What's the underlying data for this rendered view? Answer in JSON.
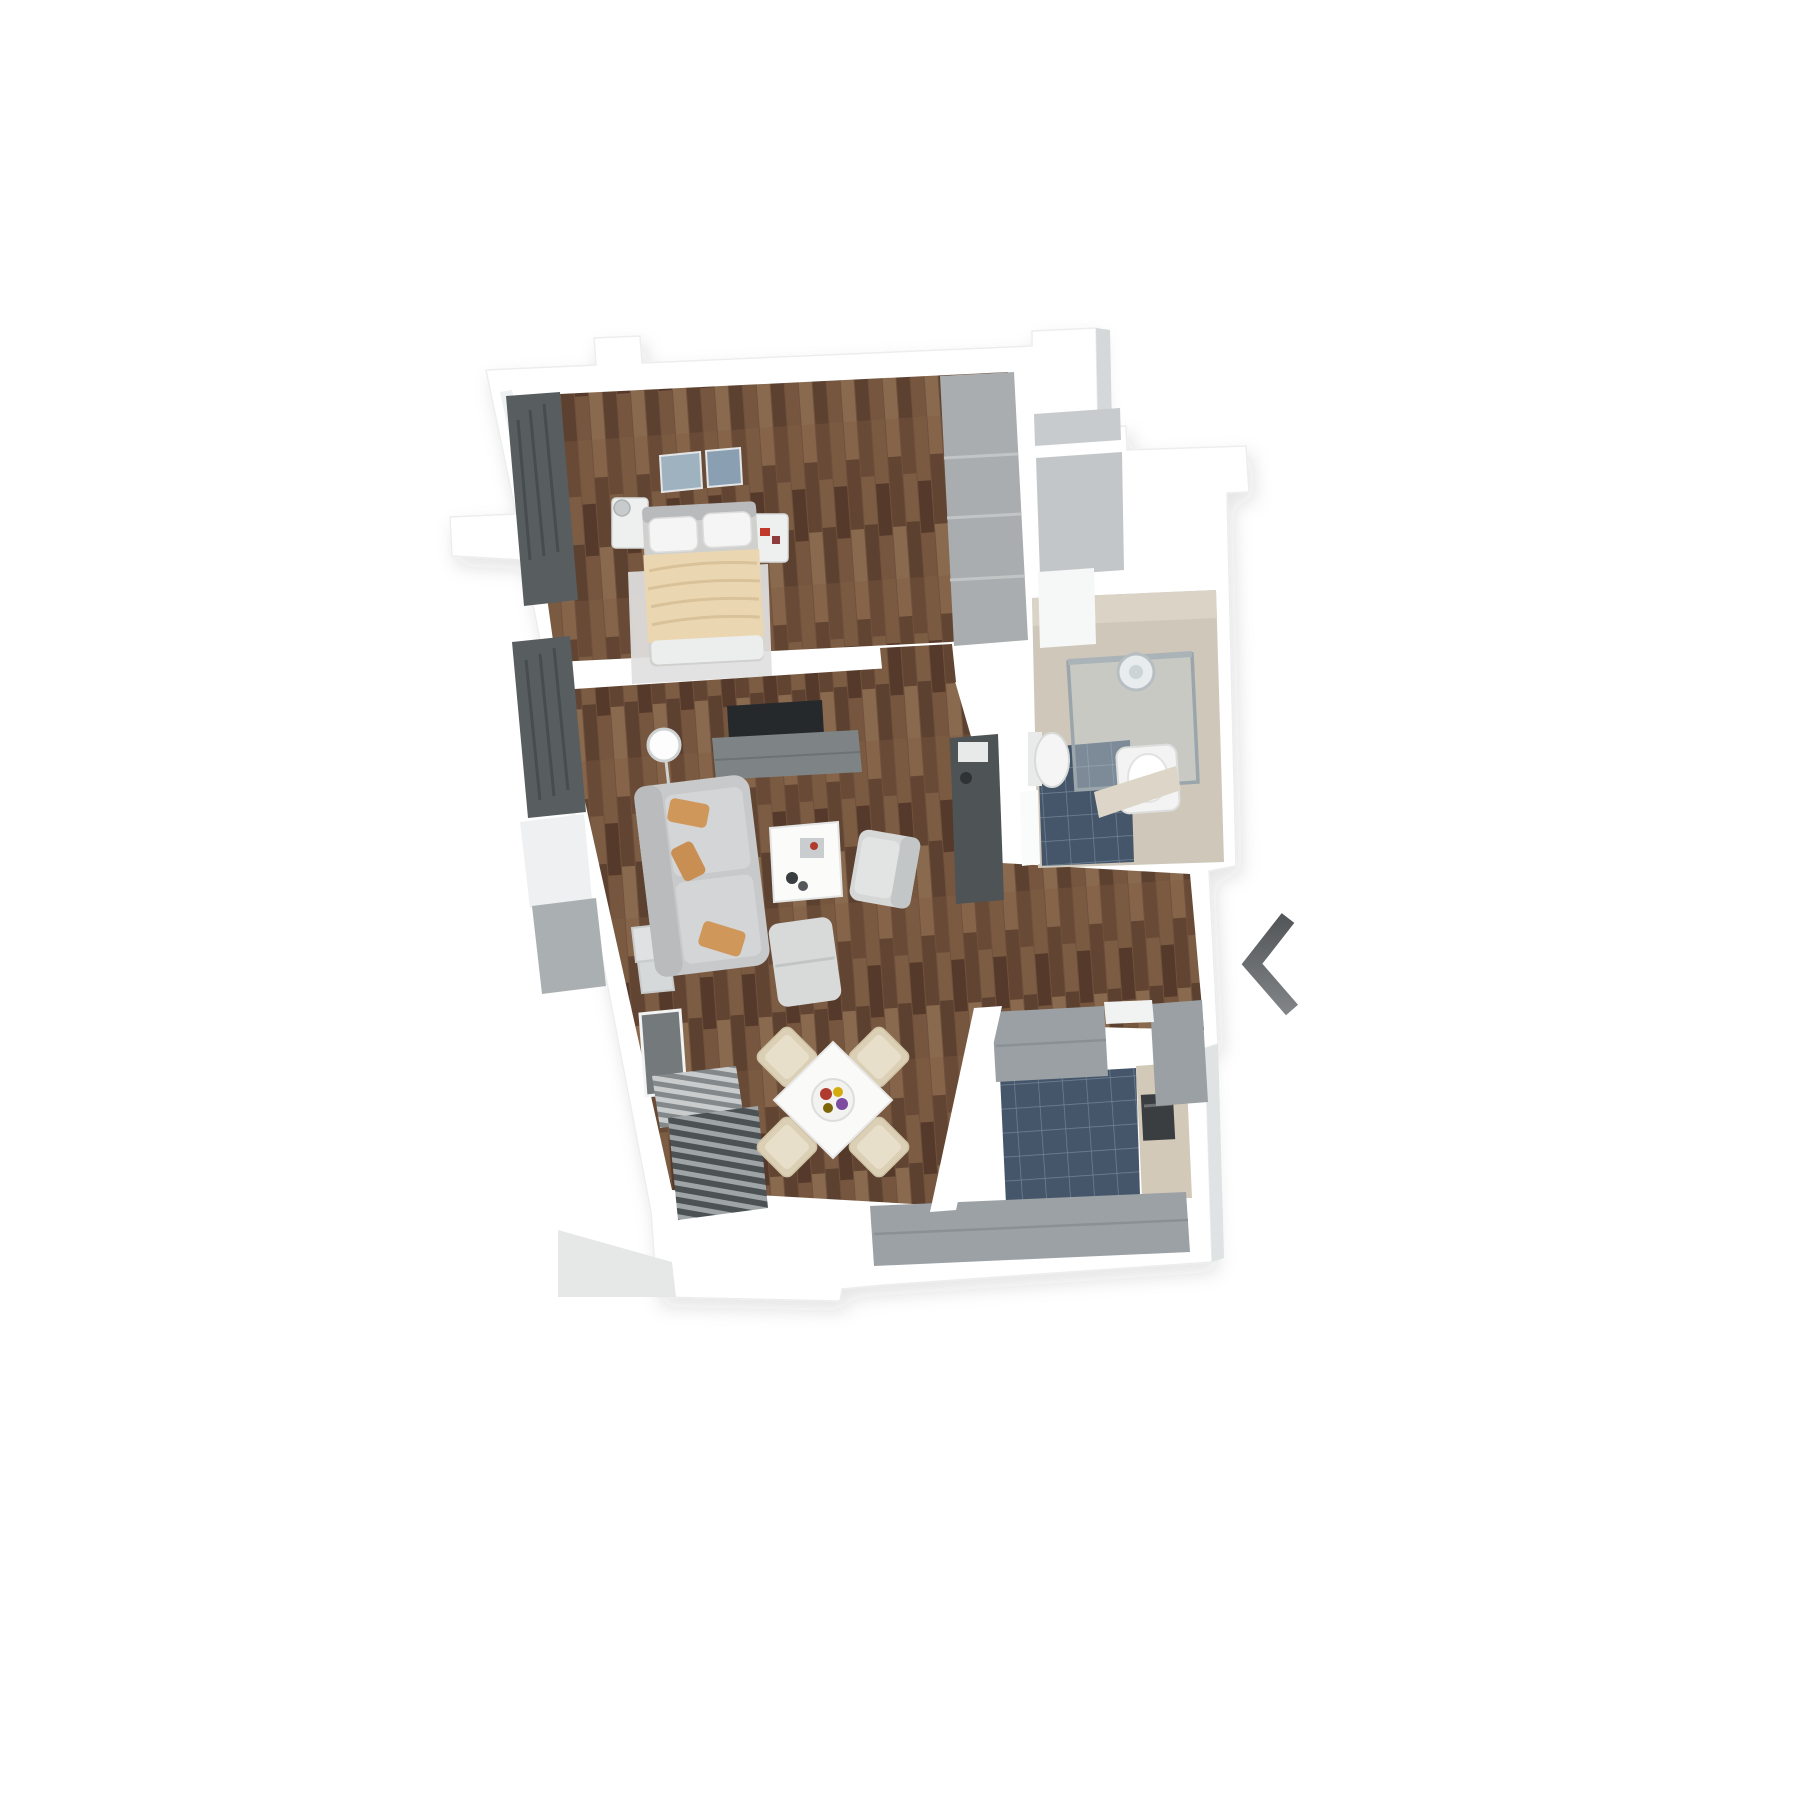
{
  "page": {
    "background": "#ffffff",
    "width": 1800,
    "height": 1800
  },
  "carousel": {
    "prev_button": {
      "icon": "chevron-left-icon",
      "color_top": "#54575a",
      "color_bottom": "#808385"
    }
  },
  "floorplan": {
    "type": "3d-floor-plan",
    "view": "top-down 3D render of a one-bedroom apartment, slightly tilted",
    "colors": {
      "walls": "#ffffff",
      "wall_face_gray": "#d5d8d8",
      "wood_floor": "#6f513c",
      "wood_plank_light": "#86644a",
      "wood_plank_dark": "#55392a",
      "tile_floor": "#46566a",
      "tile_grout": "#7d91a6",
      "hall_floor": "#c8cbcd",
      "bath_wall": "#cfc7b9",
      "bath_wall_light": "#dad3c6",
      "bath_shelf": "#ddd6c8",
      "cabinet_gray": "#9aa0a4",
      "wardrobe_gray": "#a9adaf",
      "sideboard_gray": "#7e8486",
      "sofa_gray": "#c7c9ca",
      "accent_pillow": "#d0975b",
      "bed_blanket": "#ead7b2",
      "chair_beige": "#dbcfb6",
      "radiator_dark": "#4e5356",
      "tv_dark": "#26292b",
      "curtain_dark": "#585d60",
      "fixture_white": "#f4f5f4",
      "glass": "#c2cdd2",
      "rug": "#dfe0e0",
      "appliance_dark": "#3a3e40",
      "panel_wood_light": "#d2c9b8"
    },
    "rooms": [
      {
        "name": "bedroom",
        "floor": "dark wood parquet",
        "furniture": [
          "double bed with beige blanket",
          "white pillows",
          "two nightstands",
          "bedside lamp",
          "wall art with two panels",
          "tall gray wardrobe",
          "light rug",
          "window with dark curtain"
        ]
      },
      {
        "name": "living-room",
        "floor": "dark wood parquet",
        "furniture": [
          "wall-mounted TV",
          "gray sideboard",
          "white globe floor lamp",
          "gray sofa with three tan pillows",
          "white coffee table with decor",
          "light armchair",
          "gray ottoman",
          "square dining table with fruit plate",
          "four beige dining chairs",
          "dark wall radiator",
          "gray interior door",
          "slatted blinds at balcony door",
          "windows with dark curtains",
          "wall pictures"
        ]
      },
      {
        "name": "bathroom",
        "floor": "dark blue tiles",
        "furniture": [
          "glass shower enclosure",
          "rain shower head",
          "wall-hung toilet",
          "white washbasin unit",
          "beige shelf"
        ]
      },
      {
        "name": "kitchen",
        "floor": "dark blue tiles",
        "furniture": [
          "gray worktop run",
          "second gray counter run",
          "tall oven housing with dark appliance",
          "light wood side paneling"
        ]
      },
      {
        "name": "entry-hall",
        "floor": "light gray screed",
        "furniture": []
      }
    ]
  }
}
